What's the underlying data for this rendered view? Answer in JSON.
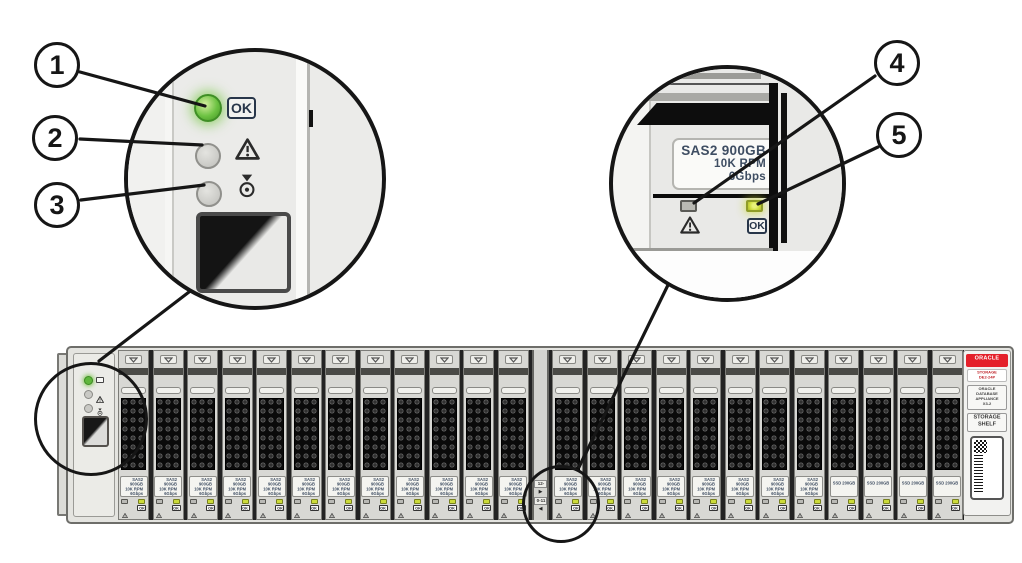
{
  "figure": {
    "callout_numbers": [
      "1",
      "2",
      "3",
      "4",
      "5"
    ]
  },
  "status_panel": {
    "ok_led": {
      "label": "OK",
      "state": "on"
    },
    "service_led": {
      "icon": "warning-triangle-icon",
      "state": "off"
    },
    "locate_led": {
      "icon": "locate-icon",
      "state": "off"
    }
  },
  "drive_detail": {
    "label_lines": [
      "SAS2 900GB",
      "10K RPM",
      "6Gbps"
    ],
    "service_icon": "warning-triangle-icon",
    "ok_label": "OK"
  },
  "shelf": {
    "drive_slots": [
      "hdd",
      "hdd",
      "hdd",
      "hdd",
      "hdd",
      "hdd",
      "hdd",
      "hdd",
      "hdd",
      "hdd",
      "hdd",
      "hdd",
      "hdd",
      "hdd",
      "hdd",
      "hdd",
      "hdd",
      "hdd",
      "hdd",
      "hdd",
      "ssd",
      "ssd",
      "ssd",
      "ssd"
    ],
    "hdd_label_lines": [
      "SAS2 900GB",
      "10K RPM",
      "6Gbps"
    ],
    "ssd_label_lines": [
      "SSD 200GB"
    ],
    "drive_ok_label": "OK",
    "divider_labels": [
      {
        "text": "12-23",
        "arrow": "▶"
      },
      {
        "text": "0-11",
        "arrow": "◀"
      }
    ],
    "endcap": {
      "brand": "ORACLE",
      "model_lines": [
        "STORAGE",
        "DE2-24P"
      ],
      "product_lines": [
        "ORACLE",
        "DATABASE",
        "APPLIANCE",
        "X3-2"
      ],
      "type_lines": [
        "STORAGE",
        "SHELF"
      ]
    }
  },
  "colors": {
    "ok_green": "#5fb73c",
    "drive_ok": "#ccdb3a",
    "oracle_red": "#e4202a",
    "label_text": "#3e4d62",
    "line": "#161616"
  }
}
